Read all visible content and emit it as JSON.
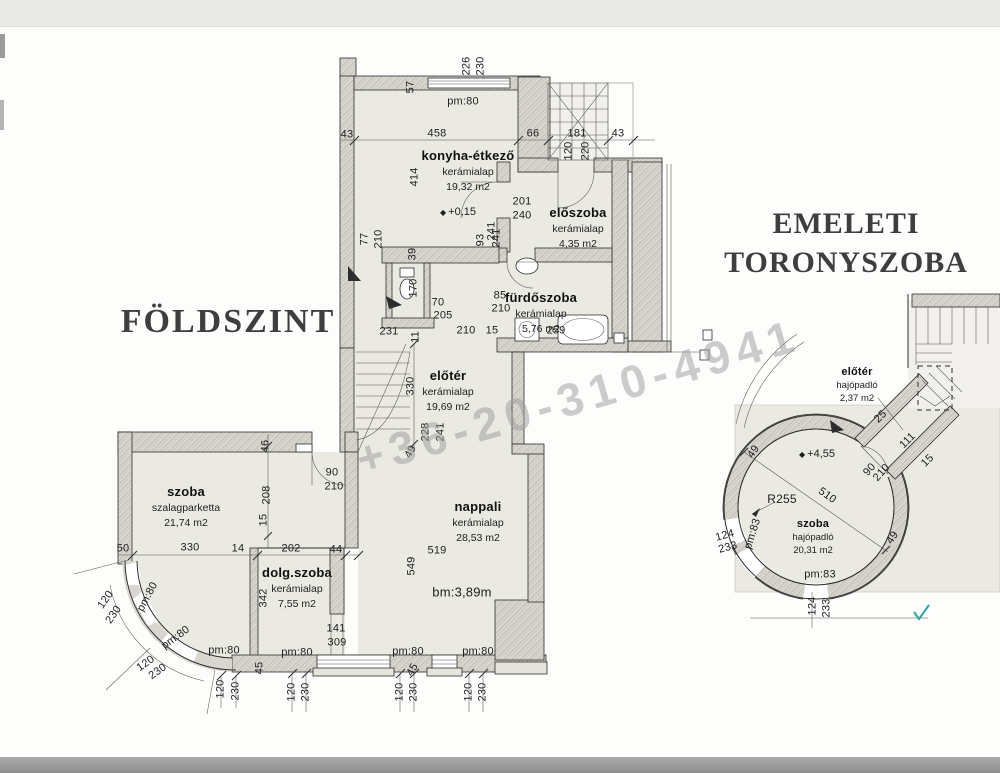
{
  "titles": {
    "ground": "FÖLDSZINT",
    "upper1": "EMELETI",
    "upper2": "TORONYSZOBA"
  },
  "watermark": "+36-20-310-4941",
  "colors": {
    "floor": "#eae9e2",
    "wall": "#d8d6cf",
    "hatch": "#bab8b1",
    "line": "#2e2e2e",
    "text": "#1e1e1e",
    "title": "#3e3e3e",
    "wm": "#9e9e9e",
    "accent": "#2aa7a0"
  },
  "rooms": [
    {
      "name": "konyha-étkező",
      "floor": "kerámialap",
      "area": "19,32 m2",
      "x": 468,
      "y": 148
    },
    {
      "name": "előszoba",
      "floor": "kerámialap",
      "area": "4,35 m2",
      "x": 578,
      "y": 205
    },
    {
      "name": "fürdőszoba",
      "floor": "kerámialap",
      "area": "5,76 m2",
      "x": 541,
      "y": 290
    },
    {
      "name": "előtér",
      "floor": "kerámialap",
      "area": "19,69 m2",
      "x": 448,
      "y": 368
    },
    {
      "name": "szoba",
      "floor": "szalagparketta",
      "area": "21,74 m2",
      "x": 186,
      "y": 484
    },
    {
      "name": "dolg.szoba",
      "floor": "kerámialap",
      "area": "7,55 m2",
      "x": 297,
      "y": 565
    },
    {
      "name": "nappali",
      "floor": "kerámialap",
      "area": "28,53 m2",
      "x": 478,
      "y": 499
    },
    {
      "name": "előtér",
      "floor": "hajópadló",
      "area": "2,37 m2",
      "x": 857,
      "y": 366,
      "small": true
    },
    {
      "name": "szoba",
      "floor": "hajópadló",
      "area": "20,31 m2",
      "x": 813,
      "y": 518,
      "small": true
    }
  ],
  "levels": [
    {
      "t": "+0,15",
      "x": 458,
      "y": 212
    },
    {
      "t": "+4,55",
      "x": 817,
      "y": 454
    }
  ],
  "dims": [
    {
      "t": "226",
      "x": 467,
      "y": 66,
      "r": -90
    },
    {
      "t": "230",
      "x": 481,
      "y": 66,
      "r": -90
    },
    {
      "t": "57",
      "x": 411,
      "y": 87,
      "r": -90
    },
    {
      "t": "pm:80",
      "x": 463,
      "y": 102
    },
    {
      "t": "43",
      "x": 347,
      "y": 135
    },
    {
      "t": "458",
      "x": 437,
      "y": 134
    },
    {
      "t": "66",
      "x": 533,
      "y": 134
    },
    {
      "t": "181",
      "x": 577,
      "y": 134
    },
    {
      "t": "43",
      "x": 618,
      "y": 134
    },
    {
      "t": "120",
      "x": 569,
      "y": 151,
      "r": -90
    },
    {
      "t": "220",
      "x": 586,
      "y": 151,
      "r": -90
    },
    {
      "t": "414",
      "x": 415,
      "y": 177,
      "r": -90
    },
    {
      "t": "201",
      "x": 522,
      "y": 202
    },
    {
      "t": "240",
      "x": 522,
      "y": 216
    },
    {
      "t": "241",
      "x": 492,
      "y": 231,
      "r": -90
    },
    {
      "t": "77",
      "x": 365,
      "y": 239,
      "r": -90
    },
    {
      "t": "210",
      "x": 379,
      "y": 239,
      "r": -90
    },
    {
      "t": "93",
      "x": 481,
      "y": 240,
      "r": -90
    },
    {
      "t": "241",
      "x": 497,
      "y": 238,
      "r": -90
    },
    {
      "t": "39",
      "x": 413,
      "y": 254,
      "r": -90
    },
    {
      "t": "170",
      "x": 414,
      "y": 288,
      "r": -90
    },
    {
      "t": "70",
      "x": 438,
      "y": 303
    },
    {
      "t": "205",
      "x": 443,
      "y": 316
    },
    {
      "t": "85",
      "x": 500,
      "y": 296
    },
    {
      "t": "210",
      "x": 501,
      "y": 309
    },
    {
      "t": "231",
      "x": 389,
      "y": 332
    },
    {
      "t": "11",
      "x": 416,
      "y": 337,
      "r": -90
    },
    {
      "t": "210",
      "x": 466,
      "y": 331
    },
    {
      "t": "15",
      "x": 492,
      "y": 331
    },
    {
      "t": "259",
      "x": 556,
      "y": 331
    },
    {
      "t": "330",
      "x": 411,
      "y": 386,
      "r": -90
    },
    {
      "t": "228",
      "x": 426,
      "y": 432,
      "r": -90
    },
    {
      "t": "241",
      "x": 441,
      "y": 432,
      "r": -90
    },
    {
      "t": "49",
      "x": 411,
      "y": 452,
      "r": -60
    },
    {
      "t": "46",
      "x": 266,
      "y": 446,
      "r": -90
    },
    {
      "t": "90",
      "x": 332,
      "y": 473
    },
    {
      "t": "210",
      "x": 334,
      "y": 487
    },
    {
      "t": "208",
      "x": 267,
      "y": 495,
      "r": -90
    },
    {
      "t": "15",
      "x": 264,
      "y": 520,
      "r": -90
    },
    {
      "t": "50",
      "x": 123,
      "y": 549
    },
    {
      "t": "330",
      "x": 190,
      "y": 548
    },
    {
      "t": "14",
      "x": 238,
      "y": 549
    },
    {
      "t": "202",
      "x": 291,
      "y": 549
    },
    {
      "t": "44",
      "x": 336,
      "y": 550
    },
    {
      "t": "342",
      "x": 264,
      "y": 598,
      "r": -90
    },
    {
      "t": "141",
      "x": 336,
      "y": 629
    },
    {
      "t": "309",
      "x": 337,
      "y": 643
    },
    {
      "t": "pm:80",
      "x": 224,
      "y": 651
    },
    {
      "t": "pm:80",
      "x": 297,
      "y": 653
    },
    {
      "t": "pm:80",
      "x": 408,
      "y": 652
    },
    {
      "t": "pm:80",
      "x": 478,
      "y": 652
    },
    {
      "t": "45",
      "x": 260,
      "y": 668,
      "r": -90
    },
    {
      "t": "45",
      "x": 413,
      "y": 670,
      "r": -60
    },
    {
      "t": "519",
      "x": 437,
      "y": 551
    },
    {
      "t": "549",
      "x": 412,
      "y": 566,
      "r": -90
    },
    {
      "t": "bm:3,89m",
      "x": 462,
      "y": 592,
      "s": 13
    },
    {
      "t": "120",
      "x": 292,
      "y": 692,
      "r": -90
    },
    {
      "t": "230",
      "x": 306,
      "y": 692,
      "r": -90
    },
    {
      "t": "120",
      "x": 400,
      "y": 692,
      "r": -90
    },
    {
      "t": "230",
      "x": 414,
      "y": 692,
      "r": -90
    },
    {
      "t": "120",
      "x": 469,
      "y": 692,
      "r": -90
    },
    {
      "t": "230",
      "x": 483,
      "y": 692,
      "r": -90
    },
    {
      "t": "120",
      "x": 221,
      "y": 689,
      "r": -90
    },
    {
      "t": "230",
      "x": 236,
      "y": 691,
      "r": -90
    },
    {
      "t": "pm:80",
      "x": 148,
      "y": 597,
      "r": -62
    },
    {
      "t": "pm:80",
      "x": 176,
      "y": 638,
      "r": -36
    },
    {
      "t": "120",
      "x": 106,
      "y": 600,
      "r": -55
    },
    {
      "t": "230",
      "x": 114,
      "y": 615,
      "r": -55
    },
    {
      "t": "120",
      "x": 146,
      "y": 664,
      "r": -35
    },
    {
      "t": "230",
      "x": 158,
      "y": 672,
      "r": -35
    },
    {
      "t": "25",
      "x": 881,
      "y": 417,
      "r": -45
    },
    {
      "t": "111",
      "x": 908,
      "y": 441,
      "r": -45
    },
    {
      "t": "15",
      "x": 928,
      "y": 461,
      "r": -45
    },
    {
      "t": "90",
      "x": 870,
      "y": 470,
      "r": -48
    },
    {
      "t": "210",
      "x": 882,
      "y": 473,
      "r": -48
    },
    {
      "t": "49",
      "x": 754,
      "y": 452,
      "r": -55
    },
    {
      "t": "49",
      "x": 893,
      "y": 538,
      "r": -55
    },
    {
      "t": "R255",
      "x": 782,
      "y": 499,
      "s": 12
    },
    {
      "t": "510",
      "x": 827,
      "y": 496,
      "r": 35
    },
    {
      "t": "124",
      "x": 725,
      "y": 536,
      "r": -15
    },
    {
      "t": "233",
      "x": 728,
      "y": 548,
      "r": -15
    },
    {
      "t": "pm:83",
      "x": 753,
      "y": 534,
      "r": -72
    },
    {
      "t": "pm:83",
      "x": 820,
      "y": 575
    },
    {
      "t": "124",
      "x": 813,
      "y": 606,
      "r": -90
    },
    {
      "t": "233",
      "x": 827,
      "y": 608,
      "r": -90
    }
  ]
}
